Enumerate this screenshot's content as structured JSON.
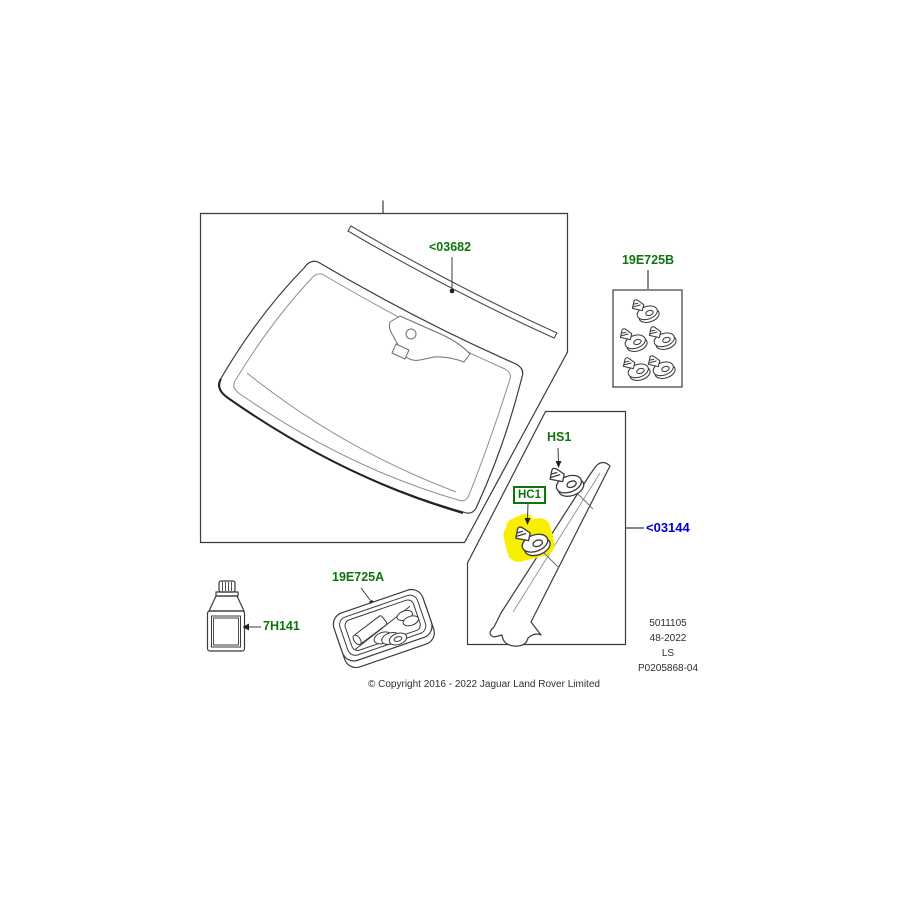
{
  "canvas": {
    "width": 900,
    "height": 900,
    "background": "#ffffff"
  },
  "callouts": {
    "windscreen_moulding": "<03682",
    "clip_pack": "19E725B",
    "screw_ref": "HS1",
    "clip_ref": "HC1",
    "a_pillar_trim": "<03144",
    "primer_bottle": "7H141",
    "fitting_kit": "19E725A"
  },
  "parts": [
    {
      "id": "windscreen-glass-with-mirror-mount",
      "callout": ""
    },
    {
      "id": "windscreen-top-moulding",
      "callout": "<03682"
    },
    {
      "id": "clip-pack-box",
      "callout": "19E725B",
      "clip_count": 5
    },
    {
      "id": "screw",
      "callout": "HS1"
    },
    {
      "id": "trim-clip",
      "callout": "HC1",
      "highlighted": true
    },
    {
      "id": "a-pillar-trim-panel",
      "callout": "<03144"
    },
    {
      "id": "primer-bottle",
      "callout": "7H141"
    },
    {
      "id": "glazing-kit-tray",
      "callout": "19E725A"
    }
  ],
  "footer": {
    "lines": [
      "5011105",
      "48-2022",
      "LS",
      "P0205868-04"
    ],
    "copyright": "© Copyright 2016 - 2022 Jaguar Land Rover Limited"
  },
  "colors": {
    "callout_green": "#0e750e",
    "callout_blue": "#0000d4",
    "highlight_yellow": "#f8ef00",
    "line_dark": "#3b3b3b",
    "line_light": "#8f8f8f"
  }
}
